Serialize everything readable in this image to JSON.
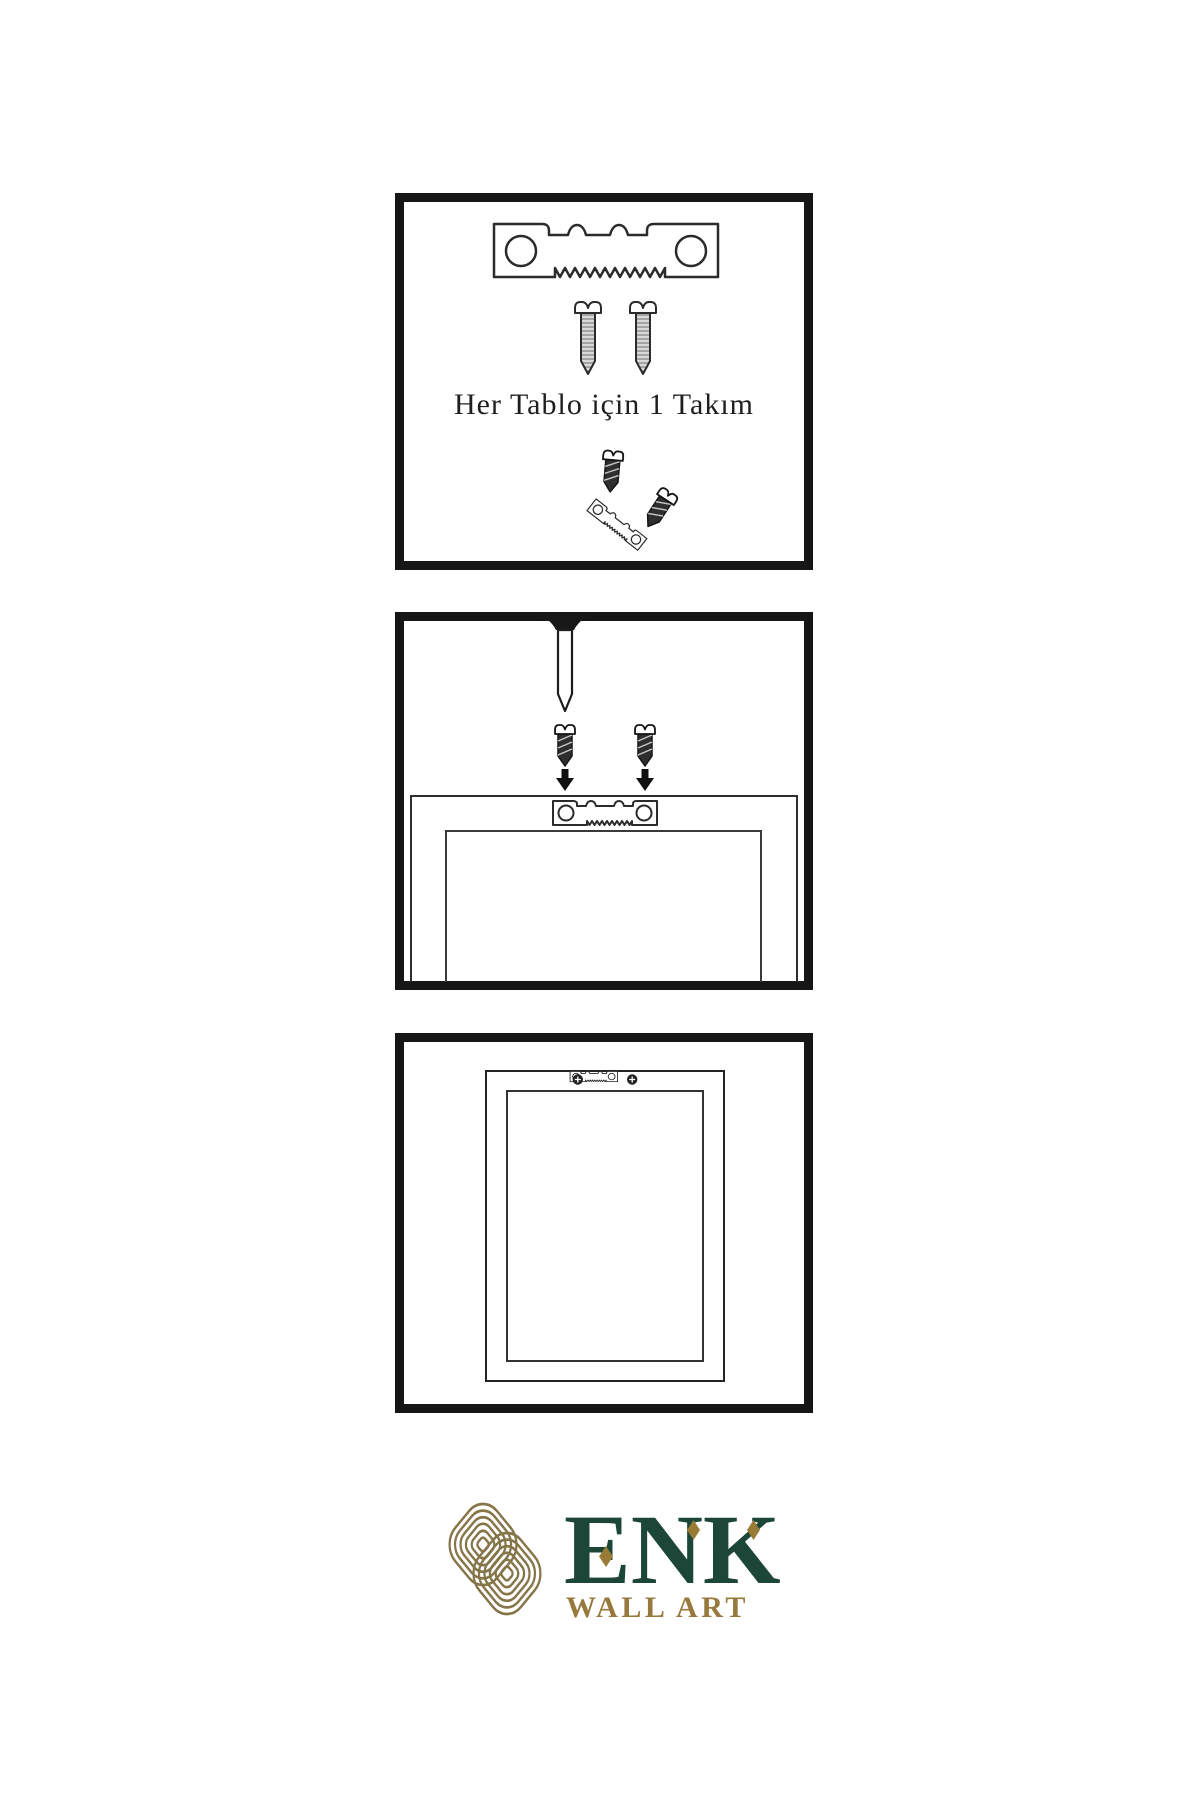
{
  "title": "wall-art-hanging-instruction-sheet",
  "colors": {
    "background": "#ffffff",
    "panel_border": "#161616",
    "ink": "#2b2b2b",
    "logo_knot_gold": "#857549",
    "logo_text_gold": "#97793d",
    "logo_diamond_gold": "#9a7b35",
    "logo_green": "#1b4638"
  },
  "panels": {
    "kit": {
      "caption": "Her Tablo için 1 Takım",
      "icons": [
        "sawtooth-hanger-icon",
        "screw-icon",
        "screw-icon",
        "screw-attach-demo-icon"
      ]
    },
    "install": {
      "icons": [
        "nail-icon",
        "screw-icon",
        "screw-icon",
        "down-arrow-icon",
        "down-arrow-icon",
        "frame-back-icon",
        "sawtooth-hanger-icon"
      ]
    },
    "hang": {
      "icons": [
        "frame-back-icon",
        "mounted-sawtooth-hanger-icon"
      ]
    }
  },
  "logo": {
    "brand": "ENK",
    "tagline": "WALL ART",
    "icon": "knot-icon"
  }
}
